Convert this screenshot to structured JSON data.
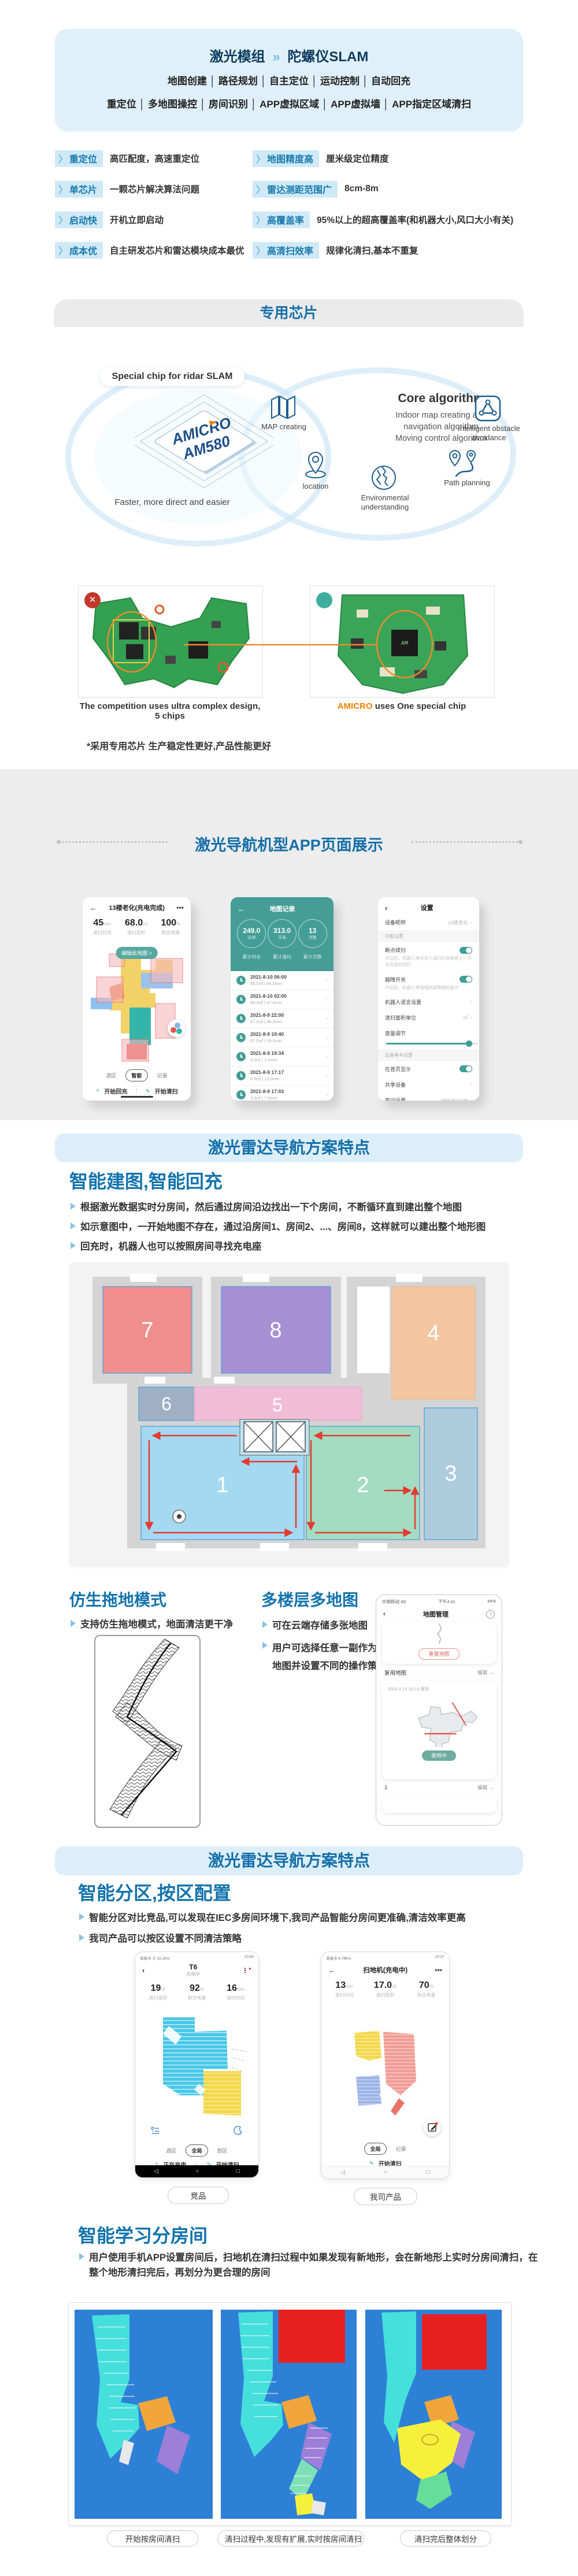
{
  "hero": {
    "title_left": "激光模组",
    "arrow_icon": "»",
    "title_right": "陀螺仪SLAM",
    "features_line1": "地图创建 │ 路径规划 │ 自主定位 │ 运动控制 │ 自动回充",
    "features_line2": "重定位 │ 多地图操控 │ 房间识别 │ APP虚拟区域 │ APP虚拟墙 │ APP指定区域清扫"
  },
  "feature_grid": [
    {
      "label": "重定位",
      "desc": "高匹配度，高速重定位"
    },
    {
      "label": "地图精度高",
      "desc": "厘米级定位精度"
    },
    {
      "label": "单芯片",
      "desc": "一颗芯片解决算法问题"
    },
    {
      "label": "雷达测距范围广",
      "desc": "8cm-8m"
    },
    {
      "label": "启动快",
      "desc": "开机立即启动"
    },
    {
      "label": "高覆盖率",
      "desc": "95%以上的超高覆盖率(和机器大小,风口大小有关)"
    },
    {
      "label": "成本优",
      "desc": "自主研发芯片和雷达模块成本最优"
    },
    {
      "label": "高清扫效率",
      "desc": "规律化清扫,基本不重复"
    }
  ],
  "chip": {
    "banner": "专用芯片",
    "pill": "Special chip for ridar SLAM",
    "brand": "AMICRO",
    "model": "AM580",
    "tagline": "Faster, more direct and easier",
    "core_title": "Core algorithm",
    "core_line1": "Indoor map creating and",
    "core_line2": "navigation algorithm",
    "core_line3": "Moving control algorithm",
    "icon_labels": [
      "MAP creating",
      "location",
      "Environmental understanding",
      "Path planning",
      "Intelligent obstacle avoidance"
    ],
    "board_left_caption": "The competition uses ultra complex design, 5 chips",
    "board_right_brand": "AMICRO",
    "board_right_caption": " uses One special chip",
    "footnote": "*采用专用芯片 生产稳定性更好,产品性能更好"
  },
  "showcase": {
    "title": "激光导航机型APP页面展示",
    "phone1": {
      "back_icon": "←",
      "title": "13楼老化(充电完成)",
      "menu_icon": "•••",
      "stats": [
        {
          "value": "45",
          "unit": "min",
          "label": "清扫时间"
        },
        {
          "value": "68.0",
          "unit": "㎡",
          "label": "清扫面积"
        },
        {
          "value": "100",
          "unit": "%",
          "label": "剩余电量"
        }
      ],
      "edit_btn": "编辑此地图 >",
      "tabs": [
        "选区",
        "智能",
        "记录"
      ],
      "btn_recharge": "开始回充",
      "btn_clean": "开始清扫"
    },
    "phone2": {
      "back_icon": "←",
      "title": "地图记录",
      "circles": [
        {
          "value": "249.0",
          "unit": "分钟",
          "label": "累计时长"
        },
        {
          "value": "313.0",
          "unit": "平米",
          "label": "累计清扫"
        },
        {
          "value": "13",
          "unit": "次数",
          "label": "累计次数"
        }
      ],
      "records": [
        {
          "time": "2021-8-10 06:00",
          "detail": "68.0㎡ | 45.0min"
        },
        {
          "time": "2021-8-10 02:00",
          "detail": "68.0㎡ | 47.0min"
        },
        {
          "time": "2021-8-9 22:00",
          "detail": "67.0㎡ | 46.0min"
        },
        {
          "time": "2021-8-9 19:40",
          "detail": "67.0㎡ | 54.0min"
        },
        {
          "time": "2021-8-9 19:34",
          "detail": "4.0㎡ | 1.0min"
        },
        {
          "time": "2021-8-9 17:17",
          "detail": "6.0㎡ | 13.0min"
        },
        {
          "time": "2021-8-9 17:03",
          "detail": "3.0㎡ | 7.0min"
        }
      ]
    },
    "phone3": {
      "back_icon": "‹",
      "title": "设置",
      "nickname_label": "设备昵称",
      "nickname_value": "13楼老化",
      "section1": "功能设置",
      "toggle1_label": "断点续扫",
      "toggle1_desc": "开启后，机器人再次进入清扫时会继续上一次未完成的清扫",
      "toggle2_label": "越障开关",
      "toggle2_desc": "开启后，机器人将增强跨越障碍的能力",
      "row_lang": "机器人语言设置",
      "row_unit_label": "清扫面积单位",
      "row_unit_value": "㎡",
      "row_volume": "音量调节",
      "section2": "设备基本设置",
      "row_home": "在首页显示",
      "row_share": "共享设备",
      "row_room_label": "房间设置",
      "row_room_value": "default room",
      "row_update": "检查更新"
    }
  },
  "nav1": {
    "banner": "激光雷达导航方案特点",
    "heading": "智能建图,智能回充",
    "bullets": [
      "根据激光数据实时分房间，然后通过房间沿边找出一下个房间，不断循环直到建出整个地图",
      "如示意图中，一开始地图不存在，通过沿房间1、房间2、...、房间8，这样就可以建出整个地形图",
      "回充时，机器人也可以按照房间寻找充电座"
    ],
    "rooms": [
      "1",
      "2",
      "3",
      "4",
      "5",
      "6",
      "7",
      "8"
    ]
  },
  "mop": {
    "heading": "仿生拖地模式",
    "bullet": "支持仿生拖地模式，地面清洁更干净"
  },
  "multimap": {
    "heading": "多楼层多地图",
    "bullets": [
      "可在云端存储多张地图",
      "用户可选择任意一副作为当前地图并设置不同的操作策略"
    ],
    "phone": {
      "status_left": "中国移动 4G",
      "status_center": "下午4:41",
      "status_right": "44%",
      "back_icon": "‹",
      "title": "地图管理",
      "help_icon": "?",
      "reset_btn": "重置地图",
      "reuse_label": "复用地图",
      "edit_link": "编辑 →",
      "map_date": "2020.4.15 15:13 保存",
      "inuse_btn": "使用中",
      "row2_label": "1",
      "edit_link2": "编辑 →"
    }
  },
  "nav2": {
    "banner": "激光雷达导航方案特点",
    "heading": "智能分区,按区配置",
    "bullets": [
      "智能分区对比竞品,可以发现在IEC多房间环境下,我司产品智能分房间更准确,清洁效率更高",
      "我司产品可以按区设置不同清洁策略"
    ],
    "phoneA": {
      "status_left": "未插卡 ⓓ 15.2K/s",
      "status_right": "10:54",
      "back_icon": "‹",
      "title": "T6",
      "subtitle": "充电中",
      "menu_icon": "⋮",
      "stats": [
        {
          "value": "19",
          "unit": "㎡",
          "label": "清扫面积"
        },
        {
          "value": "92",
          "unit": "%",
          "label": "剩余电量"
        },
        {
          "value": "16",
          "unit": "min",
          "label": "清扫时间"
        }
      ],
      "tabs": [
        "选区",
        "全局",
        "划区"
      ],
      "btn_left": "正在充电",
      "btn_right": "开始清扫"
    },
    "phoneB": {
      "status_left": "未插卡 6.78K/s",
      "status_right": "10:27",
      "back_icon": "←",
      "title": "扫地机(充电中)",
      "menu_icon": "•••",
      "stats": [
        {
          "value": "13",
          "unit": "min",
          "label": "清扫时间"
        },
        {
          "value": "17.0",
          "unit": "㎡",
          "label": "清扫面积"
        },
        {
          "value": "70",
          "unit": "%",
          "label": "剩余电量"
        }
      ],
      "tabs": [
        "全局",
        "记录"
      ],
      "btn_clean": "开始清扫"
    },
    "label_a": "竞品",
    "label_b": "我司产品"
  },
  "learning": {
    "heading": "智能学习分房间",
    "bullet": "用户使用手机APP设置房间后，扫地机在清扫过程中如果发现有新地形，会在新地形上实时分房间清扫，在整个地形清扫完后，再划分为更合理的房间",
    "captions": [
      "开始按房间清扫",
      "清扫过程中,发现有扩展,实时按房间清扫",
      "清扫完后整体划分"
    ]
  },
  "colors": {
    "accent_blue": "#156fa8",
    "heading_blue": "#1273ad",
    "teal": "#3f9f98",
    "light_blue_bg": "#dceefa",
    "hero_bg": "#e0f0fb",
    "orange": "#f08300",
    "map_blue_bg": "#2e80d6"
  }
}
